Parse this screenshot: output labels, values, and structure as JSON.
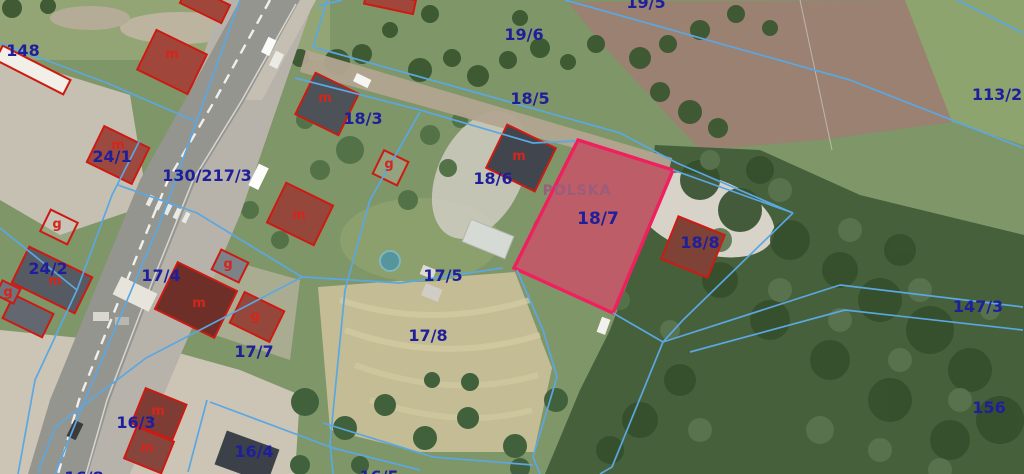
{
  "map": {
    "watermark": "POLSKA",
    "highlighted_parcel": {
      "id": "18/7",
      "label_x": 598,
      "label_y": 224,
      "label_size": 17
    },
    "parcel_labels": [
      {
        "text": "148",
        "x": 23,
        "y": 56
      },
      {
        "text": "24/1",
        "x": 112,
        "y": 162
      },
      {
        "text": "130/217/3",
        "x": 207,
        "y": 181
      },
      {
        "text": "17/4",
        "x": 161,
        "y": 281
      },
      {
        "text": "24/2",
        "x": 48,
        "y": 274
      },
      {
        "text": "18/3",
        "x": 363,
        "y": 124
      },
      {
        "text": "19/6",
        "x": 524,
        "y": 40
      },
      {
        "text": "19/5",
        "x": 646,
        "y": 8
      },
      {
        "text": "18/5",
        "x": 530,
        "y": 104
      },
      {
        "text": "18/6",
        "x": 493,
        "y": 184
      },
      {
        "text": "18/8",
        "x": 700,
        "y": 248
      },
      {
        "text": "113/2",
        "x": 997,
        "y": 100
      },
      {
        "text": "147/3",
        "x": 978,
        "y": 312
      },
      {
        "text": "156",
        "x": 989,
        "y": 413
      },
      {
        "text": "17/5",
        "x": 443,
        "y": 281
      },
      {
        "text": "17/7",
        "x": 254,
        "y": 357
      },
      {
        "text": "17/8",
        "x": 428,
        "y": 341
      },
      {
        "text": "16/3",
        "x": 136,
        "y": 428
      },
      {
        "text": "16/4",
        "x": 254,
        "y": 457
      },
      {
        "text": "16/8",
        "x": 84,
        "y": 483
      },
      {
        "text": "16/5",
        "x": 379,
        "y": 482
      }
    ],
    "building_labels": [
      {
        "text": "m",
        "x": 172,
        "y": 58
      },
      {
        "text": "m",
        "x": 118,
        "y": 149
      },
      {
        "text": "m",
        "x": 325,
        "y": 102
      },
      {
        "text": "g",
        "x": 389,
        "y": 168
      },
      {
        "text": "m",
        "x": 519,
        "y": 160
      },
      {
        "text": "m",
        "x": 299,
        "y": 219
      },
      {
        "text": "g",
        "x": 57,
        "y": 228
      },
      {
        "text": "m",
        "x": 55,
        "y": 285
      },
      {
        "text": "g",
        "x": 8,
        "y": 296
      },
      {
        "text": "m",
        "x": 199,
        "y": 307
      },
      {
        "text": "g",
        "x": 228,
        "y": 268
      },
      {
        "text": "g",
        "x": 255,
        "y": 320
      },
      {
        "text": "m",
        "x": 158,
        "y": 415
      },
      {
        "text": "m",
        "x": 147,
        "y": 452
      }
    ],
    "colors": {
      "parcel_line": "#5ba7e2",
      "parcel_label": "#1f1f9c",
      "building_outline": "#cd1a12",
      "building_label": "#d3261c",
      "highlight_border": "#f0205f",
      "highlight_fill": "rgba(238,98,134,0.5)",
      "watermark": "#9c5c7c"
    }
  }
}
